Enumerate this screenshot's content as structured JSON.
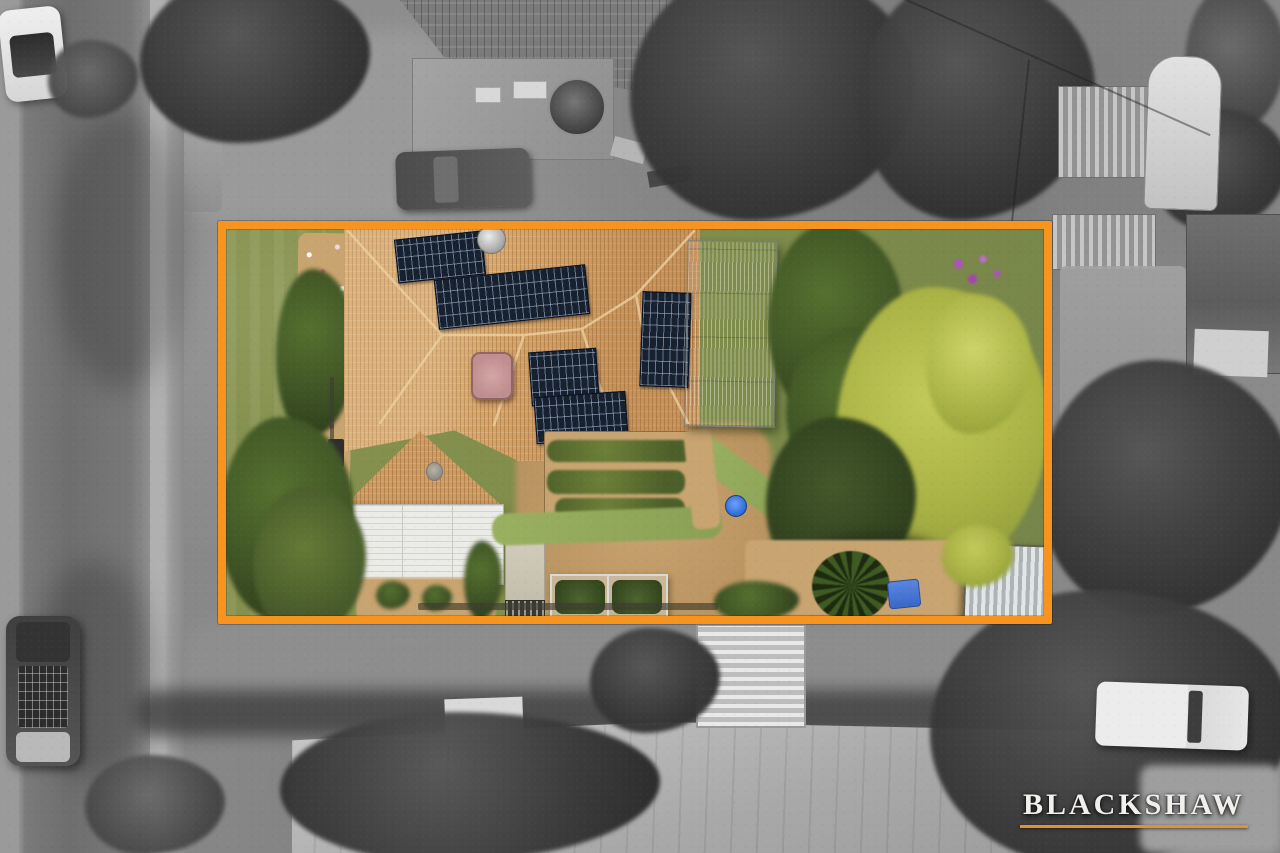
{
  "watermark": {
    "brand": "BLACKSHAW"
  },
  "colors": {
    "accent_orange": "#F7941E",
    "logo_text": "#F2F0EC",
    "logo_underline": "#E0922F",
    "roof_terracotta": "#D4A468",
    "roof_ridge": "#ECD0A0",
    "lawn_green": "#87924F",
    "tree_dark": "#3D5124",
    "tree_lime": "#A9B244",
    "soil_tan": "#C8A470",
    "solar_dark": "#16202E",
    "greenhouse_gray": "#A7B0B3",
    "carport_white": "#EBEBE7",
    "spa_pink": "#BF8E90",
    "pool_blue": "#2F6FD6",
    "road_gray": "#737373"
  },
  "scene": {
    "type": "aerial-drone-photograph",
    "style": "listed property in full colour inside an orange boundary outline; surrounding streetscape desaturated to greyscale",
    "property_features": [
      "terracotta-tile-hip-roof",
      "rooftop-solar-arrays",
      "satellite-dish",
      "spa-cover",
      "white-carport-roof",
      "greenhouse",
      "vegetable-garden-beds",
      "glasshouse-cold-frame",
      "garden-shed",
      "flower-border",
      "front-lawn",
      "mature-trees",
      "purple-flowering-shrub",
      "blue-paddling-pool",
      "blue-garden-cart"
    ],
    "surroundings_features": [
      "street-with-parked-white-car",
      "parked-4wd-with-roof-rack",
      "footpath",
      "neighbour-tiled-roof",
      "neighbour-flat-garage-roof",
      "parked-grey-car",
      "round-water-tank",
      "caravan",
      "corrugated-sheds",
      "large-metal-roof",
      "white-ute",
      "street-trees"
    ]
  }
}
